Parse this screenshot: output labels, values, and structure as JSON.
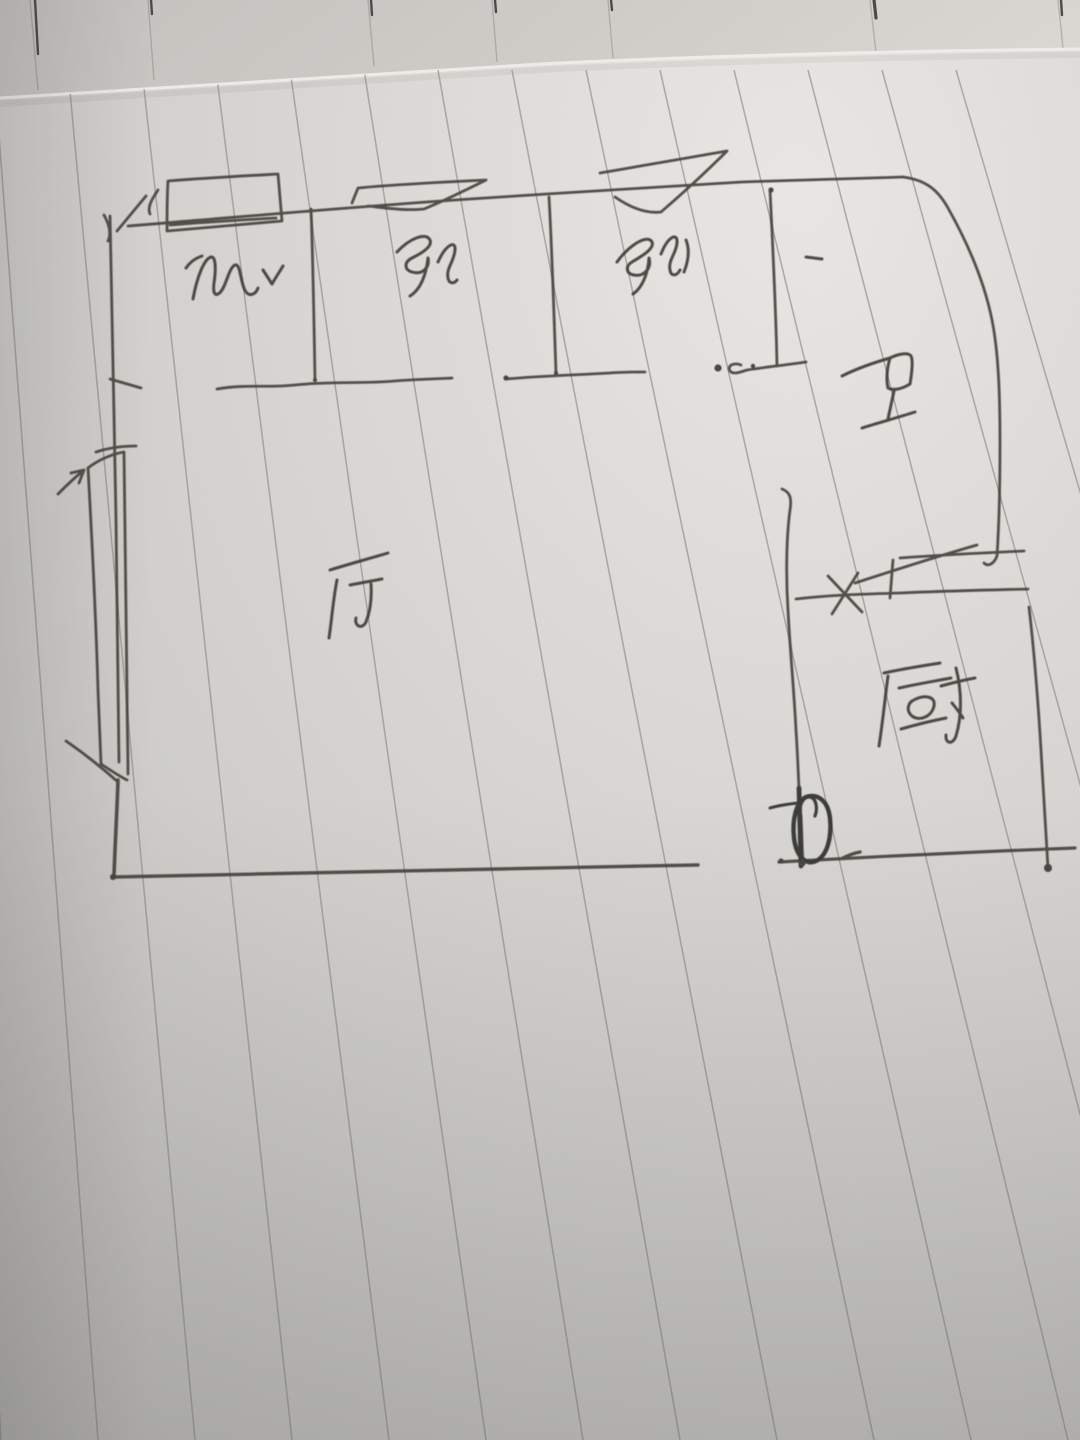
{
  "scene": {
    "description": "Hand-drawn apartment floor plan sketched in pen on vertically-ruled notebook paper, photographed at a slight angle; folded page edge visible along the top",
    "plan_shape": "three bedrooms along the top, large living room lower-left, bathroom and kitchen on the right, narrow balcony strip on the left wall"
  },
  "rooms": [
    {
      "id": "bedroom-left",
      "label": "卧",
      "position": "top-left room"
    },
    {
      "id": "bedroom-middle",
      "label": "卧",
      "position": "top-middle room"
    },
    {
      "id": "bedroom-right",
      "label": "卧",
      "position": "top-right room"
    },
    {
      "id": "bathroom",
      "label": "卫",
      "position": "middle-right"
    },
    {
      "id": "living-room",
      "label": "厅",
      "position": "center"
    },
    {
      "id": "kitchen",
      "label": "厨",
      "position": "bottom-right room"
    }
  ],
  "marks": [
    {
      "id": "check-mark",
      "position": "right of bedroom-left label"
    },
    {
      "id": "dash-mark",
      "position": "small top-right room"
    },
    {
      "id": "window-box",
      "position": "top wall, bedroom-left"
    },
    {
      "id": "window-flag-1",
      "position": "top wall, bedroom-middle"
    },
    {
      "id": "window-flag-2",
      "position": "top wall, bedroom-right"
    },
    {
      "id": "window-flag-3",
      "position": "kitchen top wall"
    },
    {
      "id": "x-mark",
      "position": "kitchen top wall"
    },
    {
      "id": "door-swing-circle",
      "position": "kitchen entrance at bottom"
    },
    {
      "id": "balcony-strip",
      "position": "outside left living-room wall"
    }
  ],
  "colors": {
    "paper_highlight": "#e9e7e3",
    "paper_mid": "#d6d4d0",
    "paper_shadow": "#bbbab6",
    "back_page": "#c9c7c2",
    "rule_line": "#8e8d8a",
    "pen": "#44423e"
  }
}
